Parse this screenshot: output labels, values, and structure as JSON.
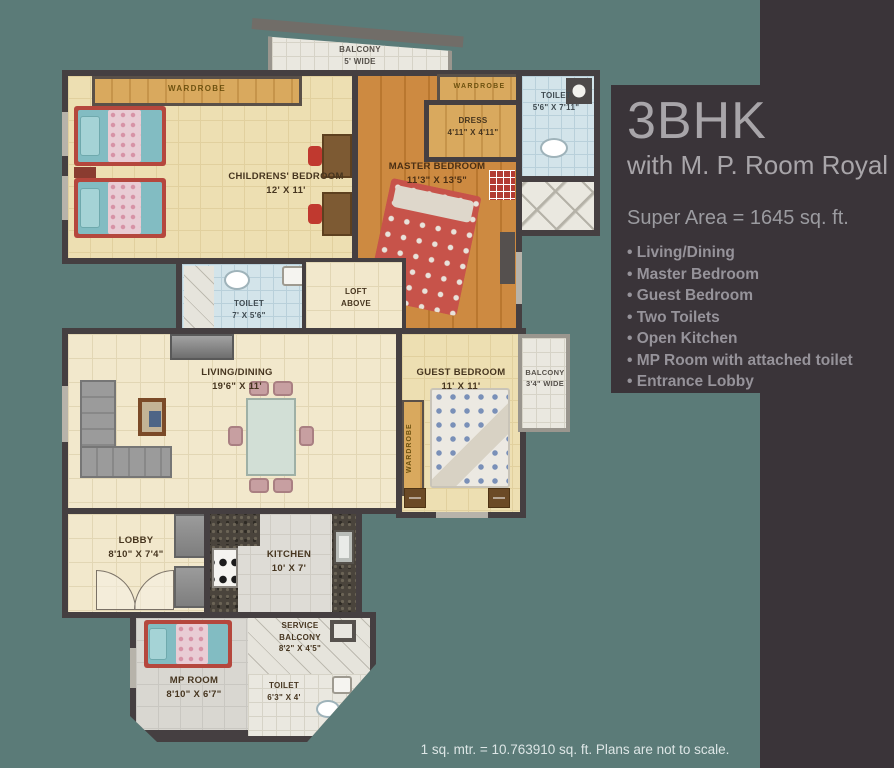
{
  "info_panel": {
    "title": "3BHK",
    "subtitle": "with M. P. Room Royal",
    "super_area": "Super Area = 1645 sq. ft.",
    "features": [
      "Living/Dining",
      "Master Bedroom",
      "Guest Bedroom",
      "Two Toilets",
      "Open Kitchen",
      "MP Room with attached toilet",
      "Entrance Lobby"
    ]
  },
  "footer_note": "1 sq. mtr. = 10.763910 sq. ft. Plans are not to scale.",
  "rooms": {
    "balcony_top": {
      "name": "BALCONY",
      "dim": "5' WIDE"
    },
    "wardrobe_childrens": {
      "name": "WARDROBE"
    },
    "childrens_bedroom": {
      "name": "CHILDRENS' BEDROOM",
      "dim": "12' X 11'"
    },
    "master_bedroom": {
      "name": "MASTER BEDROOM",
      "dim": "11'3\" X 13'5\""
    },
    "wardrobe_master": {
      "name": "WARDROBE"
    },
    "dress": {
      "name": "DRESS",
      "dim": "4'11\" X 4'11\""
    },
    "toilet_top": {
      "name": "TOILET",
      "dim": "5'6\" X 7'11\""
    },
    "toilet_mid": {
      "name": "TOILET",
      "dim": "7' X 5'6\""
    },
    "loft": {
      "name": "LOFT ABOVE"
    },
    "living_dining": {
      "name": "LIVING/DINING",
      "dim": "19'6\" X 11'"
    },
    "guest_bedroom": {
      "name": "GUEST BEDROOM",
      "dim": "11' X 11'"
    },
    "wardrobe_guest": {
      "name": "WARDROBE"
    },
    "balcony_right": {
      "name": "BALCONY",
      "dim": "3'4\" WIDE"
    },
    "lobby": {
      "name": "LOBBY",
      "dim": "8'10\" X 7'4\""
    },
    "kitchen": {
      "name": "KITCHEN",
      "dim": "10' X 7'"
    },
    "mp_room": {
      "name": "MP ROOM",
      "dim": "8'10\" X 6'7\""
    },
    "service_balcony": {
      "name": "SERVICE BALCONY",
      "dim": "8'2\" X 4'5\""
    },
    "toilet_bottom": {
      "name": "TOILET",
      "dim": "6'3\" X 4'"
    }
  },
  "colors": {
    "teal-bg": "#5b7b78",
    "panel-bg": "#3a3439",
    "panel-text": "#a8a5a9",
    "panel-list-text": "#96939a",
    "wall": "#453f41",
    "floor-cream": "#f2e8cc",
    "grid-cream": "#e2d6b4",
    "floor-yellow": "#eddfb2",
    "wood": "#c9823c",
    "wood-light": "#d7a75c",
    "tile-blue": "#d3e4ea",
    "tile-white": "#eae8e0",
    "kitchen-floor": "#dedcd6",
    "label-text": "#46351f",
    "footer-text": "#dde6e6"
  }
}
